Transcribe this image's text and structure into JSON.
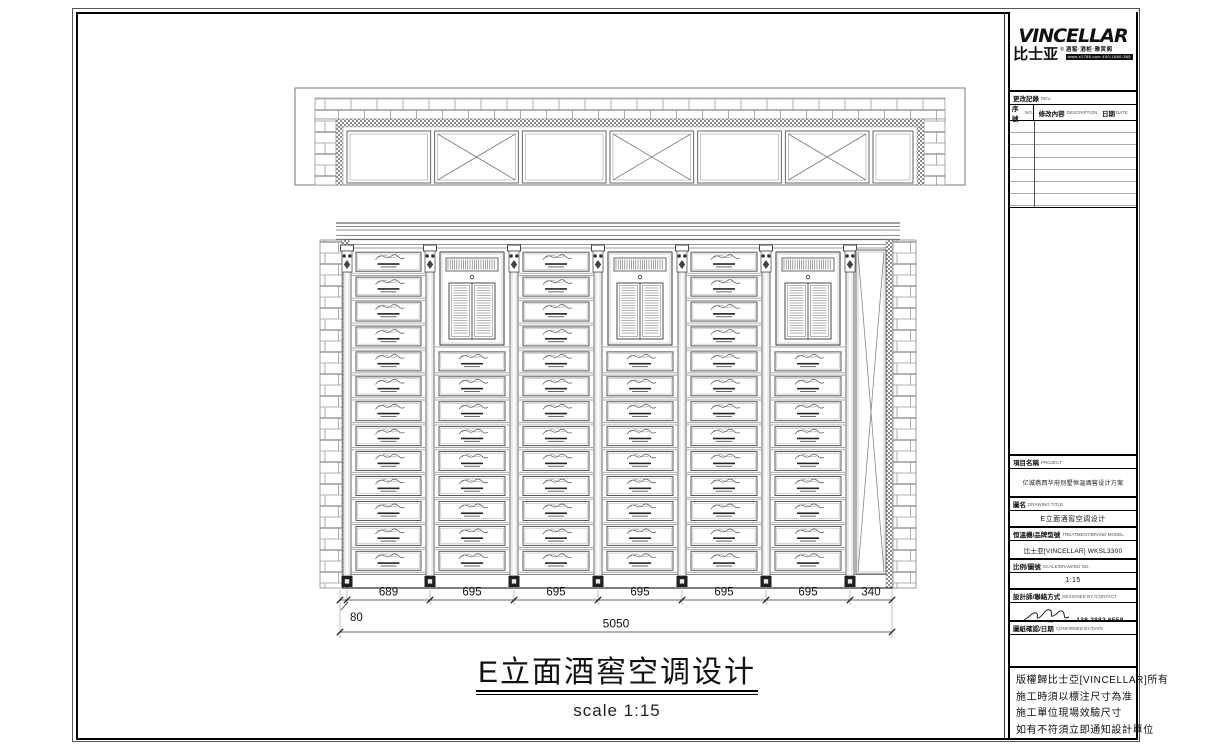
{
  "sheet": {
    "drawing_title": "E立面酒窖空调设计",
    "scale_caption": "scale 1:15"
  },
  "brand": {
    "wordmark": "VINCELLAR",
    "cn_name": "比士亚",
    "reg_mark": "®",
    "tagline": "酒窖·酒柜·雅赏阁",
    "website": "www.x1788.com 400-1860-365"
  },
  "revision": {
    "section_label": "更改記錄",
    "section_label_en": "REV.",
    "col_no": "序號",
    "col_no_en": "NO.",
    "col_desc": "修改內容",
    "col_desc_en": "DESCRIPTION",
    "col_date": "日期",
    "col_date_en": "DATE",
    "empty_rows": 7
  },
  "info_sections": {
    "project": {
      "label": "項目名稱",
      "label_en": "PROJECT",
      "value": "亿城燕西华府别墅恒温酒窖设计方案"
    },
    "drawing": {
      "label": "圖名",
      "label_en": "DRAWING TITLE",
      "value": "E立面酒窖空调设计"
    },
    "equipment": {
      "label": "恒溫機/品牌型號",
      "label_en": "TREATMENT/BRAND MODEL",
      "value": "比士亚[VINCELLAR] WKSL3300"
    },
    "scale": {
      "label": "比例/圖號",
      "label_en": "SCALE/DRAWING NO.",
      "value": "1:15"
    },
    "designer": {
      "label": "設計師/聯絡方式",
      "label_en": "DESIGNED BY /CONTACT",
      "value": "138 2882 6558"
    },
    "confirm": {
      "label": "圖紙確認/日期",
      "label_en": "CONFIRMED BY/DATE",
      "value": ""
    }
  },
  "notes": [
    "版權歸比士亞[VINCELLAR]所有",
    "施工時須以標注尺寸為准",
    "施工單位現場效驗尺寸",
    "如有不符須立即通知設計單位"
  ],
  "dimensions": {
    "bays": [
      "689",
      "695",
      "695",
      "695",
      "695",
      "695",
      "340"
    ],
    "left_offset": "80",
    "total": "5050"
  },
  "elevation": {
    "bay_count": 6,
    "rows_per_bay": 13,
    "ac_bays": [
      1,
      3,
      5
    ],
    "ac_rows_span": 4,
    "top_strip_x_panels": [
      1,
      3,
      5
    ],
    "top_strip_panel_count": 7
  }
}
